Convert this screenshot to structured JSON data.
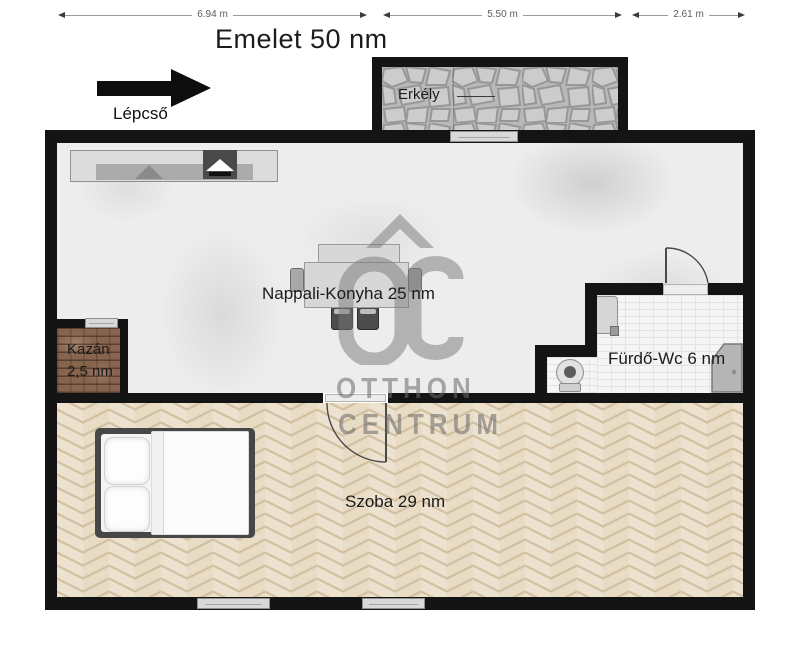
{
  "title": "Emelet 50 nm",
  "dimensions": {
    "d1": "6.94 m",
    "d2": "5.50 m",
    "d3": "2.61 m"
  },
  "stairs": {
    "label": "Lépcső"
  },
  "rooms": {
    "balcony": {
      "label": "Erkély"
    },
    "living": {
      "label": "Nappali-Konyha 25 nm"
    },
    "boiler": {
      "label_line1": "Kazán",
      "label_line2": "2,5 nm"
    },
    "bathroom": {
      "label": "Fürdő-Wc 6 nm"
    },
    "bedroom": {
      "label": "Szoba 29 nm"
    }
  },
  "watermark": {
    "monogram": "OC",
    "line1": "OTTHON",
    "line2": "CENTRUM"
  },
  "colors": {
    "wall": "#141414",
    "window_fill": "#d9d9d9",
    "living_floor": "#ededed",
    "bedroom_floor": "#e8dcc5",
    "parquet_line": "#d3c1a1",
    "stone_bg": "#b9b9b9",
    "stone_fill": "#cccccc",
    "stone_line": "#979797",
    "boiler_brick": "#87644d",
    "tile_bg": "#f5f5f5",
    "tile_line": "#e3e3e3",
    "watermark": "#787878"
  }
}
